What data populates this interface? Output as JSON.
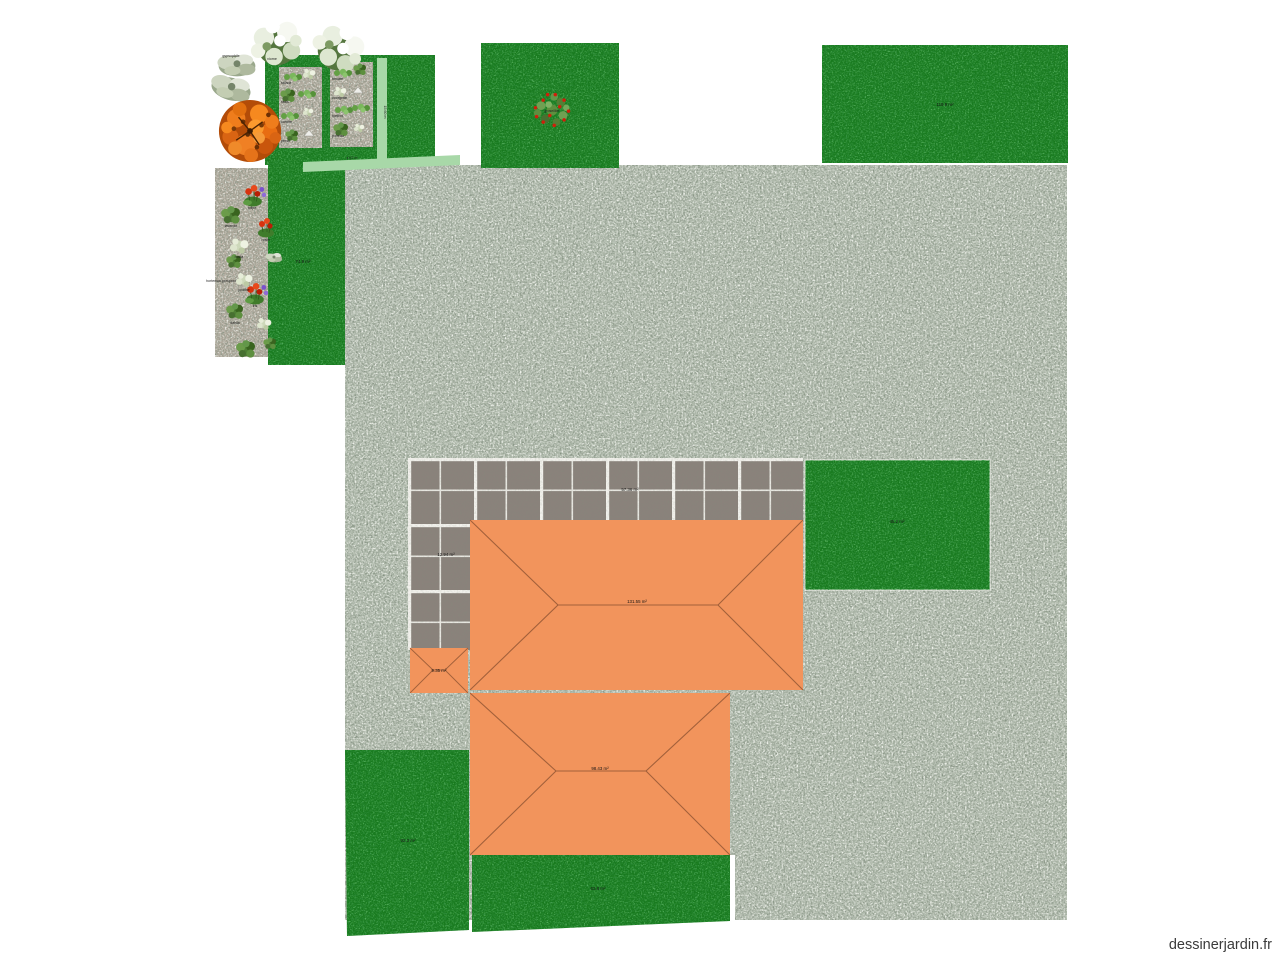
{
  "watermark": {
    "text": "dessinerjardin.fr"
  },
  "colors": {
    "grass": "#187a1e",
    "gravel": "#b3bdaf",
    "bed_gravel": "#b0a99c",
    "tile": "#8a827b",
    "grout": "#f2f1ec",
    "roof": "#f2945c",
    "roof_line": "#a2603a",
    "path_green": "#a8d8a8",
    "tree_foliage": "#e5731a"
  },
  "areas": {
    "left_lawn_label": "74.9 m²",
    "top_right_lawn_label": "119.9 m²",
    "right_lawn_label": "45.2 m²",
    "bottom_left_lawn_label": "92.3 m²",
    "bottom_strip_lawn_label": "63.8 m²",
    "patio_label": "57.36 m²",
    "terrace_label": "12.94 m²"
  },
  "buildings": {
    "house_main_label": "131.55 m²",
    "house_second_label": "98.43 m²",
    "garage_label": "9.35 m²"
  },
  "paths": {
    "vertical_label": "15.60 m",
    "diagonal_label": "4.57 m"
  },
  "plants": {
    "specimen_bush_label": "viorne",
    "specimen_gray_label": "gypsophile",
    "berry_bush_label": "groseillier",
    "bed1": [
      "salade",
      "radis",
      "carotte",
      "persil"
    ],
    "bed2": [
      "tomate",
      "courgette",
      "haricot",
      "poireau"
    ],
    "border": [
      "tulipe",
      "lavande",
      "rosier",
      "hosta",
      "pivoine",
      "iris",
      "dahlia"
    ],
    "border_side_label": "hortensia grimpant"
  }
}
